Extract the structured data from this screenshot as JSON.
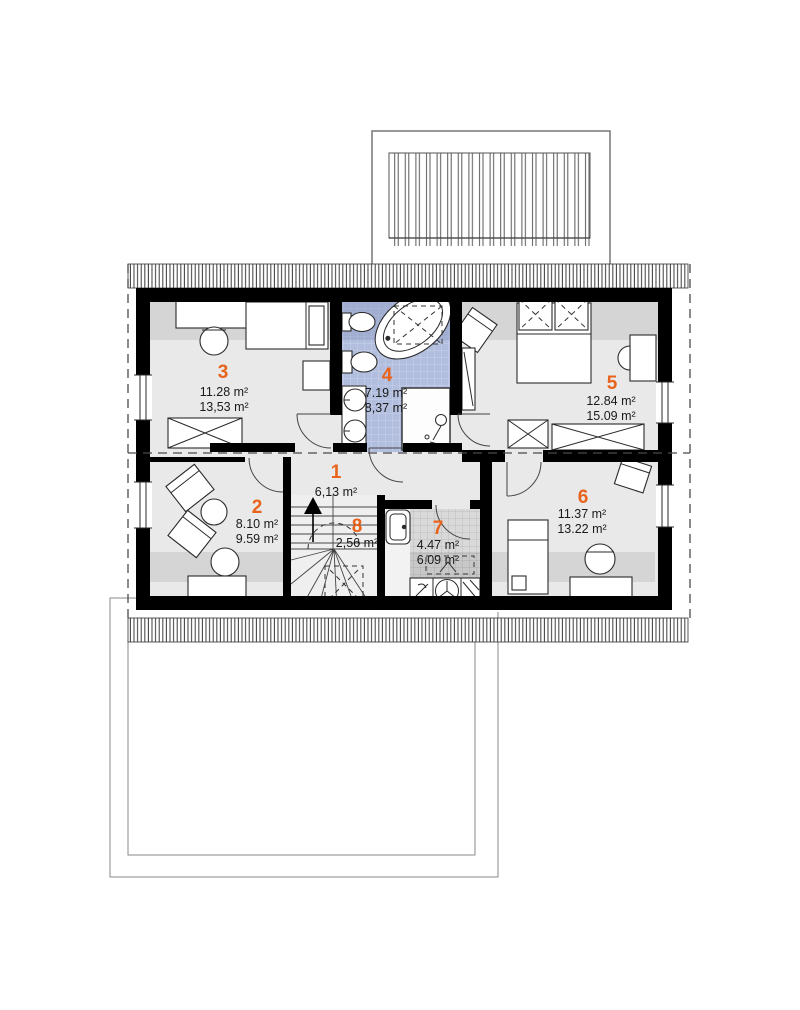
{
  "drawing": {
    "title": "attic-floor-plan",
    "accent_color": "#e8641c",
    "bath_tile_color": "#b2bedd",
    "floor_color": "#e9e9e9",
    "rooms": [
      {
        "number": "1",
        "areas": [
          "6,13 m²"
        ]
      },
      {
        "number": "2",
        "areas": [
          "8.10 m²",
          "9.59 m²"
        ]
      },
      {
        "number": "3",
        "areas": [
          "11.28 m²",
          "13,53 m²"
        ]
      },
      {
        "number": "4",
        "areas": [
          "7.19 m²",
          "8,37 m²"
        ]
      },
      {
        "number": "5",
        "areas": [
          "12.84 m²",
          "15.09 m²"
        ]
      },
      {
        "number": "6",
        "areas": [
          "11.37 m²",
          "13.22 m²"
        ]
      },
      {
        "number": "7",
        "areas": [
          "4.47 m²",
          "6.09 m²"
        ]
      },
      {
        "number": "8",
        "areas": [
          "2,56 m²"
        ]
      }
    ]
  }
}
